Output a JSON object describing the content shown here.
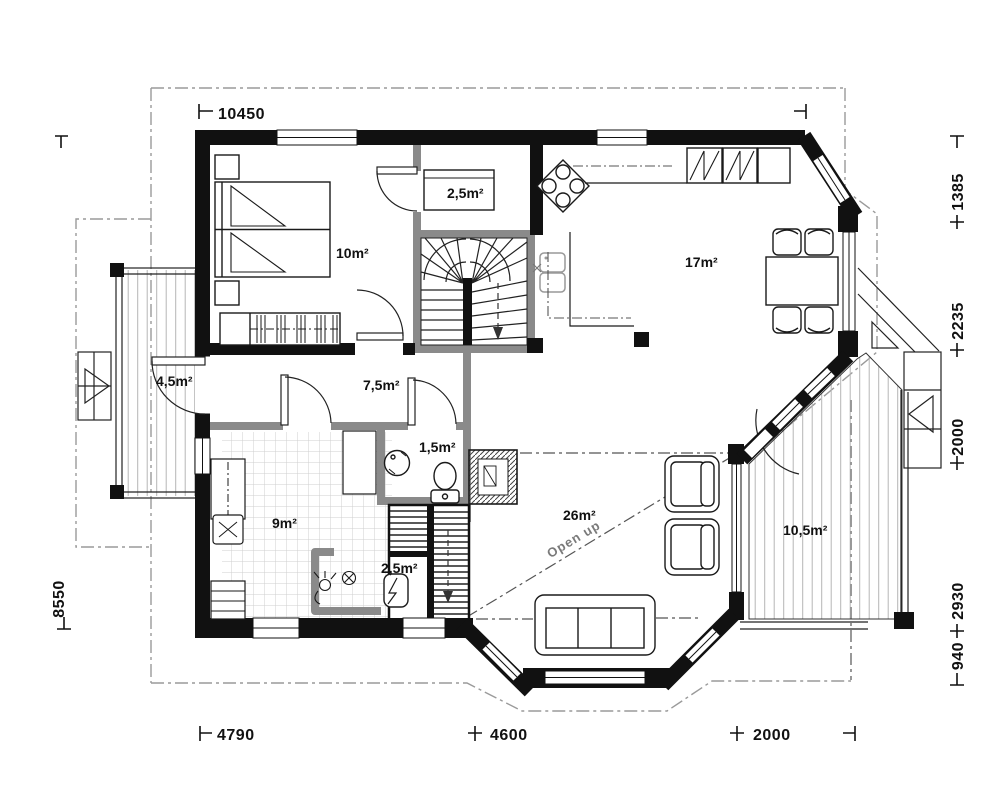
{
  "plan": {
    "rooms": {
      "bedroom": "10m²",
      "closet": "2,5m²",
      "kitchen_dining": "17m²",
      "porch": "4,5m²",
      "hall": "7,5m²",
      "wc": "1,5m²",
      "utility": "9m²",
      "shower": "2,5m²",
      "living": "26m²",
      "deck": "10,5m²"
    },
    "annotations": {
      "open_up": "Open  up"
    },
    "dimensions": {
      "top": "10450",
      "left": "8550",
      "bottom": [
        "4790",
        "4600",
        "2000"
      ],
      "right": [
        "1385",
        "2235",
        "2000",
        "2930",
        "940"
      ]
    },
    "colors": {
      "wall": "#111111",
      "partition": "#8a8a8a",
      "dash_gray": "#9a9a9a",
      "dash_dark": "#555555"
    }
  }
}
